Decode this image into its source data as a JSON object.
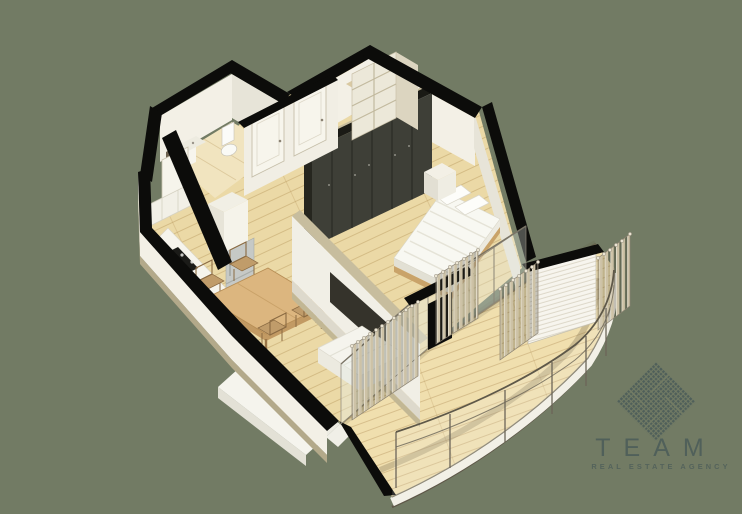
{
  "brand": {
    "name": "TEAM",
    "tagline": "REAL ESTATE AGENCY"
  },
  "colors": {
    "bg": "#727B64",
    "ink": "#0C0C0A",
    "wall_light": "#F3F0E6",
    "wall_shade": "#E7E4D8",
    "wood": "#EBD9A6",
    "deck": "#F0DFAE",
    "trim_tan": "#C7BD9E",
    "plinth": "#B3A98A",
    "wardrobe": "#3E3F37",
    "wood_dark": "#C9A369",
    "metal": "#6B6557",
    "slat": "#CDC2A6",
    "tv": "#35332B",
    "fridge": "#C6C9C6",
    "logo": "#4F5F5A"
  },
  "scene": {
    "type": "isometric-apartment-floor-plan-render",
    "rooms": [
      "bathroom",
      "hallway",
      "bedroom",
      "kitchen",
      "living-room",
      "balcony"
    ],
    "furniture": [
      "toilet",
      "sink-cabinet",
      "interior-doors",
      "entry-shelving",
      "wardrobe",
      "double-bed",
      "pillows",
      "nightstand",
      "tv-panel",
      "sofa",
      "ottoman",
      "dining-table",
      "dining-chairs",
      "kitchen-counter",
      "cooktop",
      "fridge",
      "wall-cabinets",
      "balcony-slat-screens",
      "glass-railing",
      "curved-deck"
    ]
  }
}
